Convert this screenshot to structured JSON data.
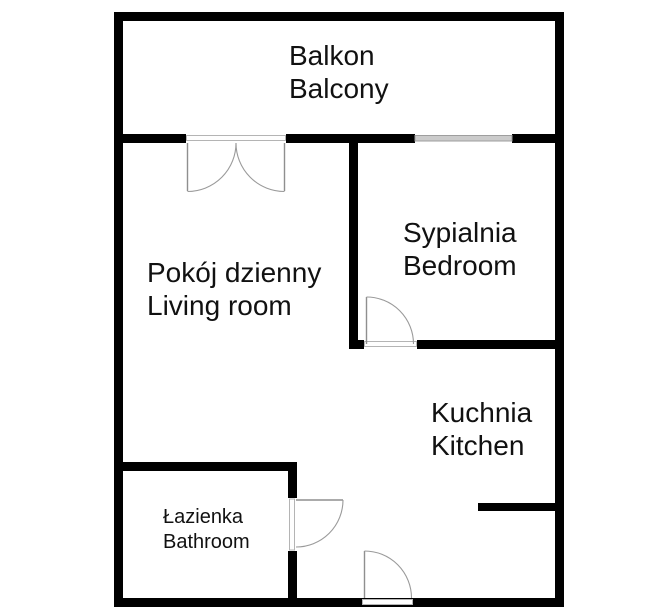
{
  "title": "Apartment floor plan",
  "colors": {
    "background": "#ffffff",
    "wall": "#000000",
    "door": "#8f8f8f",
    "door_frame": "#b4b4b4",
    "window": "#cbcbcb",
    "text": "#111111"
  },
  "rooms": [
    {
      "id": "balcony",
      "name_pl": "Balkon",
      "name_en": "Balcony"
    },
    {
      "id": "living-room",
      "name_pl": "Pokój dzienny",
      "name_en": "Living room"
    },
    {
      "id": "bedroom",
      "name_pl": "Sypialnia",
      "name_en": "Bedroom"
    },
    {
      "id": "kitchen",
      "name_pl": "Kuchnia",
      "name_en": "Kitchen"
    },
    {
      "id": "bathroom",
      "name_pl": "Łazienka",
      "name_en": "Bathroom"
    }
  ],
  "features": {
    "doors": [
      "balcony-double-door",
      "bedroom-door",
      "bathroom-door",
      "entrance-door"
    ],
    "windows": [
      "bedroom-balcony-window"
    ]
  }
}
